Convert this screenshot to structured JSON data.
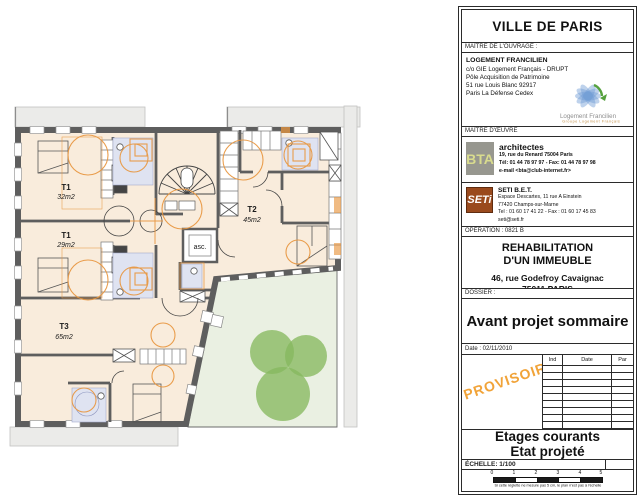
{
  "plan": {
    "units": [
      {
        "label": "T1",
        "area": "32m2"
      },
      {
        "label": "T1",
        "area": "29m2"
      },
      {
        "label": "T2",
        "area": "45m2"
      },
      {
        "label": "T3",
        "area": "65m2"
      }
    ],
    "elevator_label": "asc.",
    "colors": {
      "floor": "#f9ecdc",
      "wall": "#5e5e5e",
      "furniture_orange": "#e8963f",
      "bath_blue": "#dfe3f1",
      "garden": "#eaf0e2",
      "tree": "#86b85f",
      "neighbor": "#ebebe9"
    }
  },
  "titleblock": {
    "city": "VILLE DE PARIS",
    "owner_band": "MAÎTRE DE L'OUVRAGE :",
    "owner": {
      "name": "LOGEMENT FRANCILIEN",
      "line1": "c/o GIE Logement Français - DRUPT",
      "line2": "Pôle Acquisition de Patrimoine",
      "line3": "51 rue Louis Blanc 92917",
      "line4": "Paris La Défense Cedex",
      "logo_name": "Logement Francilien",
      "logo_sub": "Groupe Logement Français"
    },
    "architect_band": "MAÎTRE D'ŒUVRE",
    "architect": {
      "logo": "BTA",
      "title": "architectes",
      "line1": "19, rue du Renard  75004 Paris",
      "line2": "Tél: 01 44 78 97 97 - Fax: 01 44 78 97 98",
      "line3": "e-mail <bta@club-internet.fr>"
    },
    "engineer": {
      "logo": "SETi",
      "name": "SETI B.E.T.",
      "line1": "Espace Descartes, 11 rue A Einstein",
      "line2": "77420 Champs-sur-Marne",
      "line3": "Tel : 01 60 17 41 22 - Fax : 01 60 17 45 83",
      "line4": "seti@seti.fr"
    },
    "operation_band": "OPÉRATION : 0821 B",
    "project": {
      "line1": "REHABILITATION",
      "line2": "D'UN IMMEUBLE",
      "address1": "46, rue Godefroy Cavaignac",
      "address2": "75011 PARIS"
    },
    "dossier_band": "DOSSIER :",
    "dossier_title": "Avant projet sommaire",
    "date_band": "Date : 02/11/2010",
    "stamp": "PROVISOIRE",
    "revisions": {
      "headers": [
        "Ind",
        "Date",
        "Par"
      ],
      "rows": 9
    },
    "sheet": {
      "line1": "Etages courants",
      "line2": "Etat projeté"
    },
    "scale_band": "ÉCHELLE: 1/100",
    "scalebar": {
      "ticks": [
        "0",
        "1",
        "2",
        "3",
        "4",
        "5"
      ],
      "caption": "Si cette réglette ne mesure pas 5 cm, le plan n'est pas à l'échelle"
    }
  }
}
